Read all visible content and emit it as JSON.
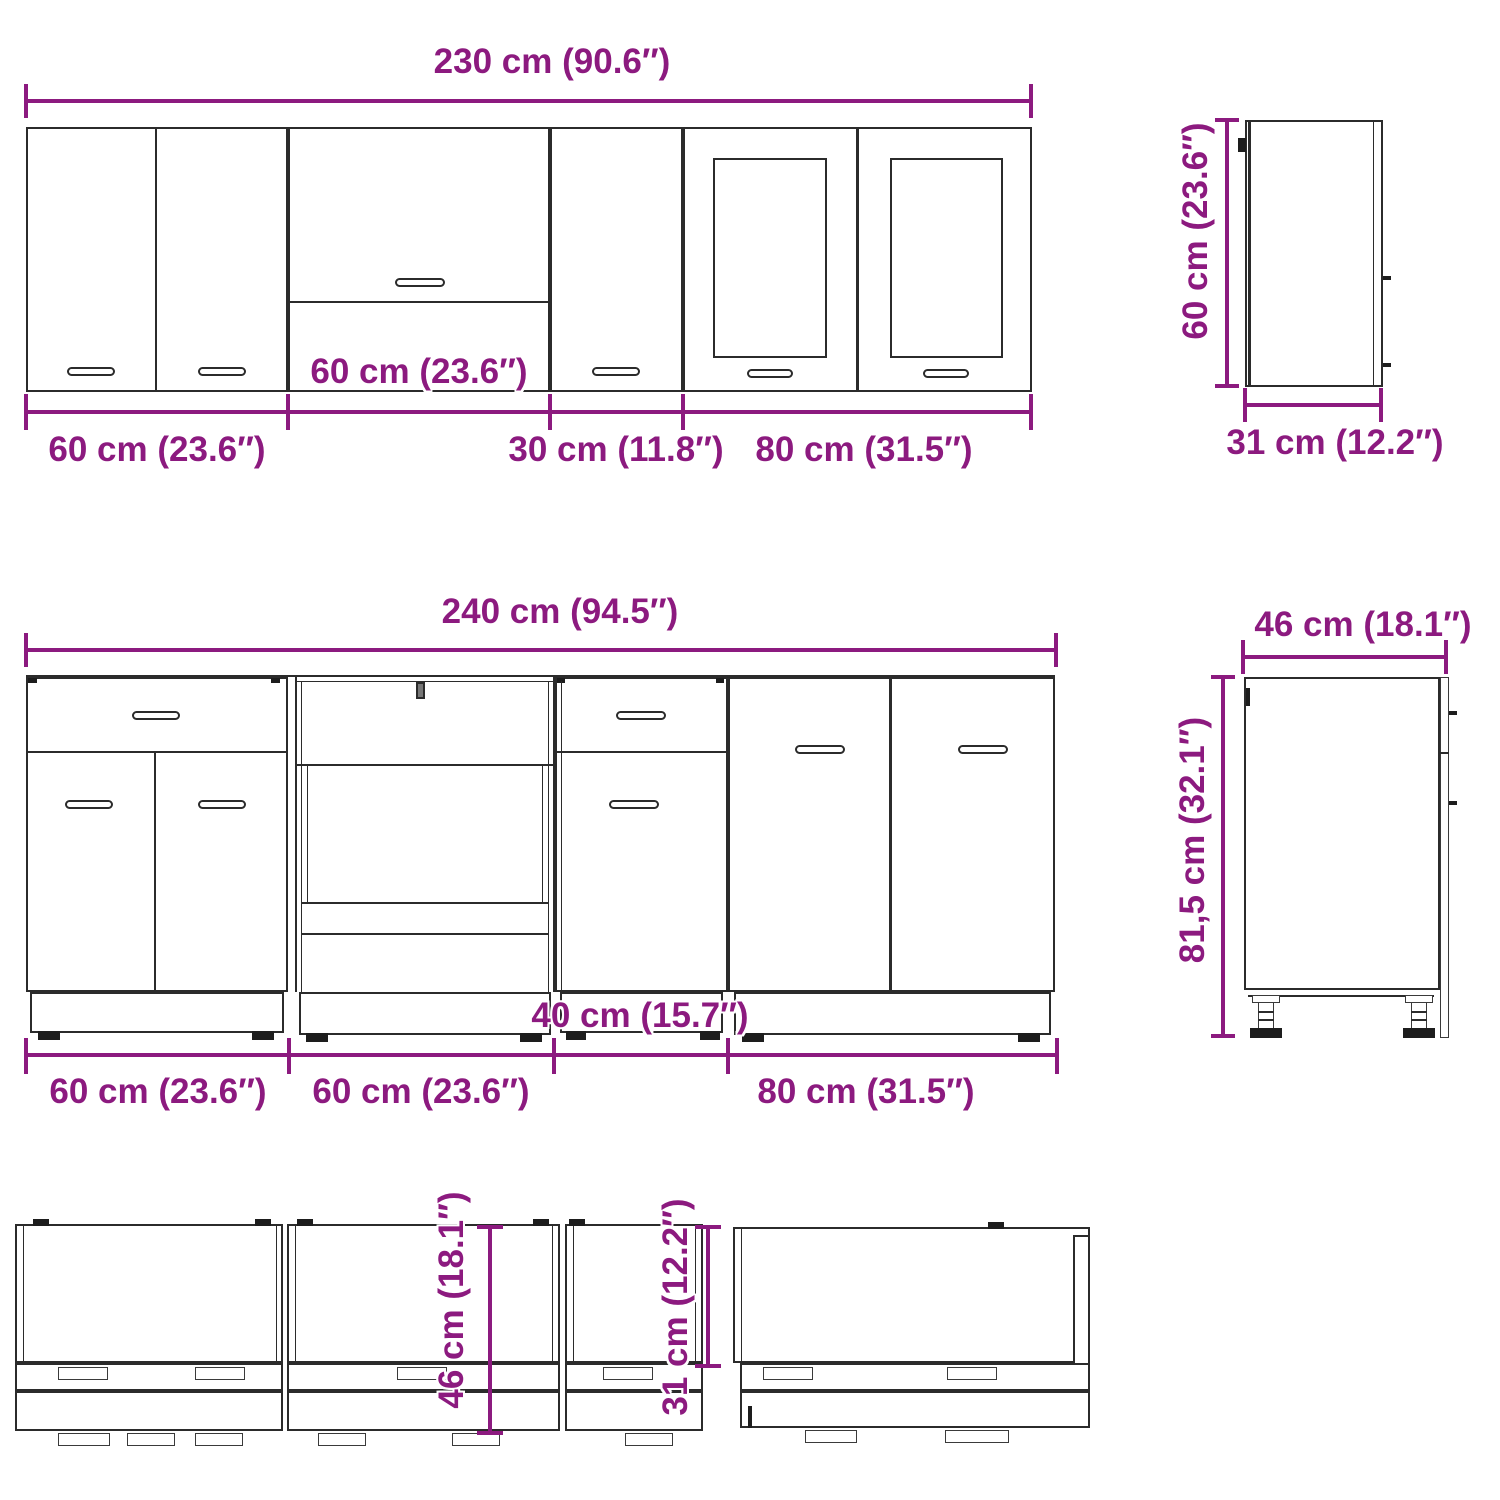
{
  "colors": {
    "dimension_text": "#8c1a7f",
    "outline": "#2b2b2b"
  },
  "wall": {
    "total": "230 cm (90.6″)",
    "seg60a": "60 cm (23.6″)",
    "seg60b": "60 cm (23.6″)",
    "seg30": "30 cm (11.8″)",
    "seg80": "80 cm (31.5″)",
    "side_height": "60 cm (23.6″)",
    "side_depth": "31 cm (12.2″)"
  },
  "base": {
    "total": "240 cm (94.5″)",
    "seg60a": "60 cm (23.6″)",
    "seg60b": "60 cm (23.6″)",
    "seg40": "40 cm (15.7″)",
    "seg80": "80 cm (31.5″)",
    "side_width": "46 cm (18.1″)",
    "side_height": "81,5 cm (32.1″)"
  },
  "plan": {
    "depth_base": "46 cm (18.1″)",
    "depth_wall": "31 cm (12.2″)"
  }
}
